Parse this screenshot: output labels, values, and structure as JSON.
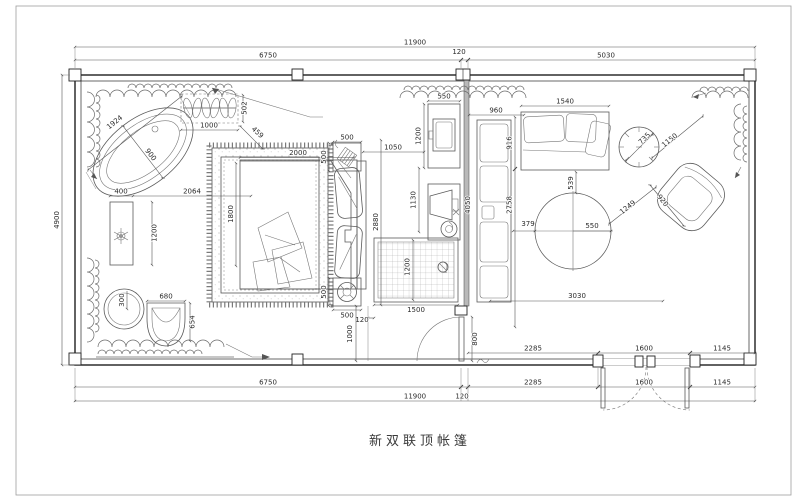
{
  "title": "新双联顶帐篷",
  "dims": {
    "top_total": "11900",
    "top_left": "6750",
    "top_col": "120",
    "top_right": "5030",
    "left_height": "4900",
    "botA_1": "2285",
    "botA_2": "1600",
    "botA_3": "1145",
    "botB_left": "6750",
    "botB_1": "2285",
    "botB_2": "1600",
    "botB_3": "1145",
    "botC_total": "11900",
    "botC_col": "120",
    "tub_length": "1924",
    "tub_width": "900",
    "rack_width": "1000",
    "rack_depth": "502",
    "rack_offset": "459",
    "console_width": "400",
    "console_to_rug": "2064",
    "console_length": "1200",
    "stool_radius": "300",
    "tubchair_width": "680",
    "tubchair_depth": "654",
    "rug_height": "1800",
    "bed_length": "2000",
    "bed_width": "2880",
    "nightstand_top_w": "500",
    "nightstand_top_d": "500",
    "nightstand_bot_d": "500",
    "nightstand_bot_w": "500",
    "bed_to_cabinet": "1050",
    "cabinet_width": "550",
    "cabinet_depth": "1200",
    "tv_depth": "1130",
    "shower_width": "1500",
    "shower_depth": "1200",
    "shower_gap": "120",
    "entry_depth": "1000",
    "door_width": "800",
    "bench_offset": "960",
    "sofa_depth": "916",
    "partition_length": "4050",
    "bench_length": "2758",
    "sofa_width": "1540",
    "sidetable_dia": "735",
    "table_dia": "550",
    "table_gap_left": "379",
    "table_gap_top": "539",
    "table_to_chair": "1249",
    "armchair_width": "1150",
    "armchair_depth": "920",
    "sitting_width": "3030"
  }
}
